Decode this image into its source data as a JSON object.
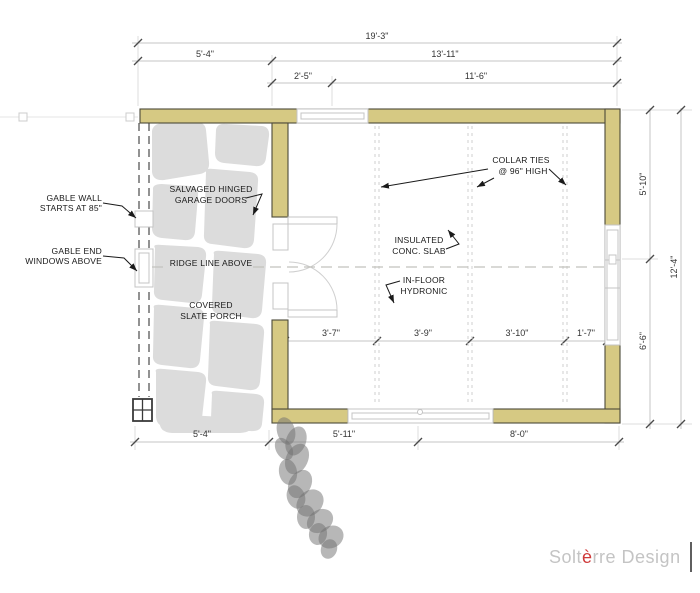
{
  "dimensions": {
    "top": {
      "overall": "19'-3\"",
      "porch": "5'-4\"",
      "main": "13'-11\"",
      "offset": "2'-5\"",
      "span": "11'-6\""
    },
    "bottom": {
      "porch": "5'-4\"",
      "mid": "5'-11\"",
      "right": "8'-0\""
    },
    "collar_spacing": {
      "d1": "3'-7\"",
      "d2": "3'-9\"",
      "d3": "3'-10\"",
      "d4": "1'-7\""
    },
    "right": {
      "upper": "5'-10\"",
      "lower": "6'-6\"",
      "overall": "12'-4\""
    }
  },
  "annotations": {
    "gable_wall": {
      "line1": "GABLE WALL",
      "line2": "STARTS AT 85\""
    },
    "gable_end": {
      "line1": "GABLE END",
      "line2": "WINDOWS ABOVE"
    },
    "garage_doors": {
      "line1": "SALVAGED HINGED",
      "line2": "GARAGE DOORS"
    },
    "ridge": {
      "line1": "RIDGE LINE ABOVE"
    },
    "porch": {
      "line1": "COVERED",
      "line2": "SLATE PORCH"
    },
    "collar_ties": {
      "line1": "COLLAR TIES",
      "line2": "@ 96\" HIGH"
    },
    "slab": {
      "line1": "INSULATED",
      "line2": "CONC. SLAB"
    },
    "hydronic": {
      "line1": "IN-FLOOR",
      "line2": "HYDRONIC"
    }
  },
  "logo": {
    "part1": "Solt",
    "accent": "è",
    "part2": "rre Design"
  },
  "colors": {
    "wall": "#d6c983",
    "wall_outline": "#4c4a3a",
    "stone": "#dcdcdc",
    "shrub": "#6f6f6f",
    "dim_line": "#c6c6c6",
    "logo_gray": "#c4c4c4",
    "logo_red": "#cf3a3a",
    "logo_bar": "#5f5f5f"
  }
}
